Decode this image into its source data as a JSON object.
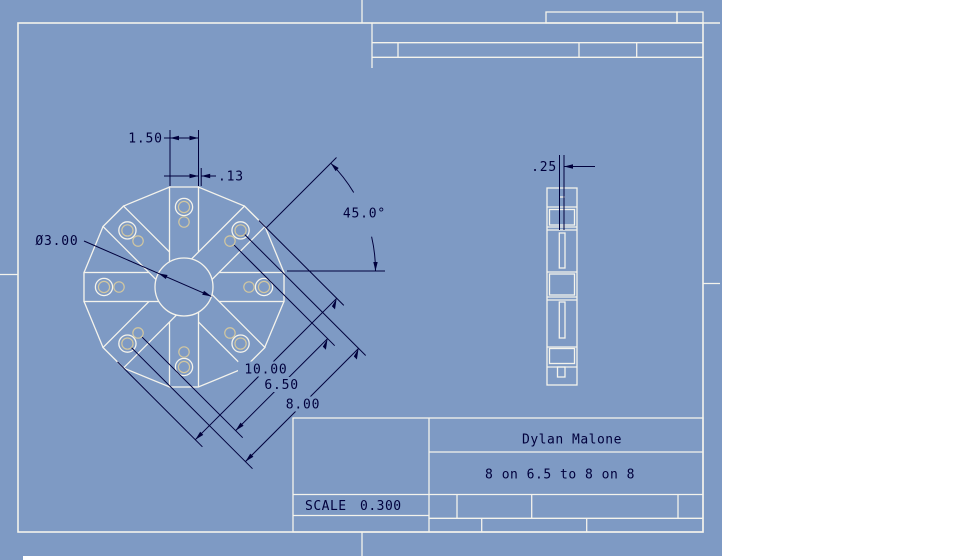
{
  "colors": {
    "background": "#7e9ac4",
    "line": "#f4f3ec",
    "hidden": "#d2c7a0",
    "dimension": "#00003c",
    "canvas": "#ffffff"
  },
  "front_view": {
    "dims": {
      "tab_width": "1.50",
      "tab_offset": ".13",
      "bore_diameter": "Ø3.00",
      "angle": "45.0°",
      "outer_span": "10.00",
      "inner_bolt_circle": "6.50",
      "outer_bolt_circle": "8.00"
    }
  },
  "side_view": {
    "dims": {
      "plate_thickness": ".25"
    }
  },
  "title_block": {
    "author": "Dylan Malone",
    "title": "8 on 6.5 to 8 on 8",
    "scale_label": "SCALE",
    "scale_value": "0.300"
  }
}
